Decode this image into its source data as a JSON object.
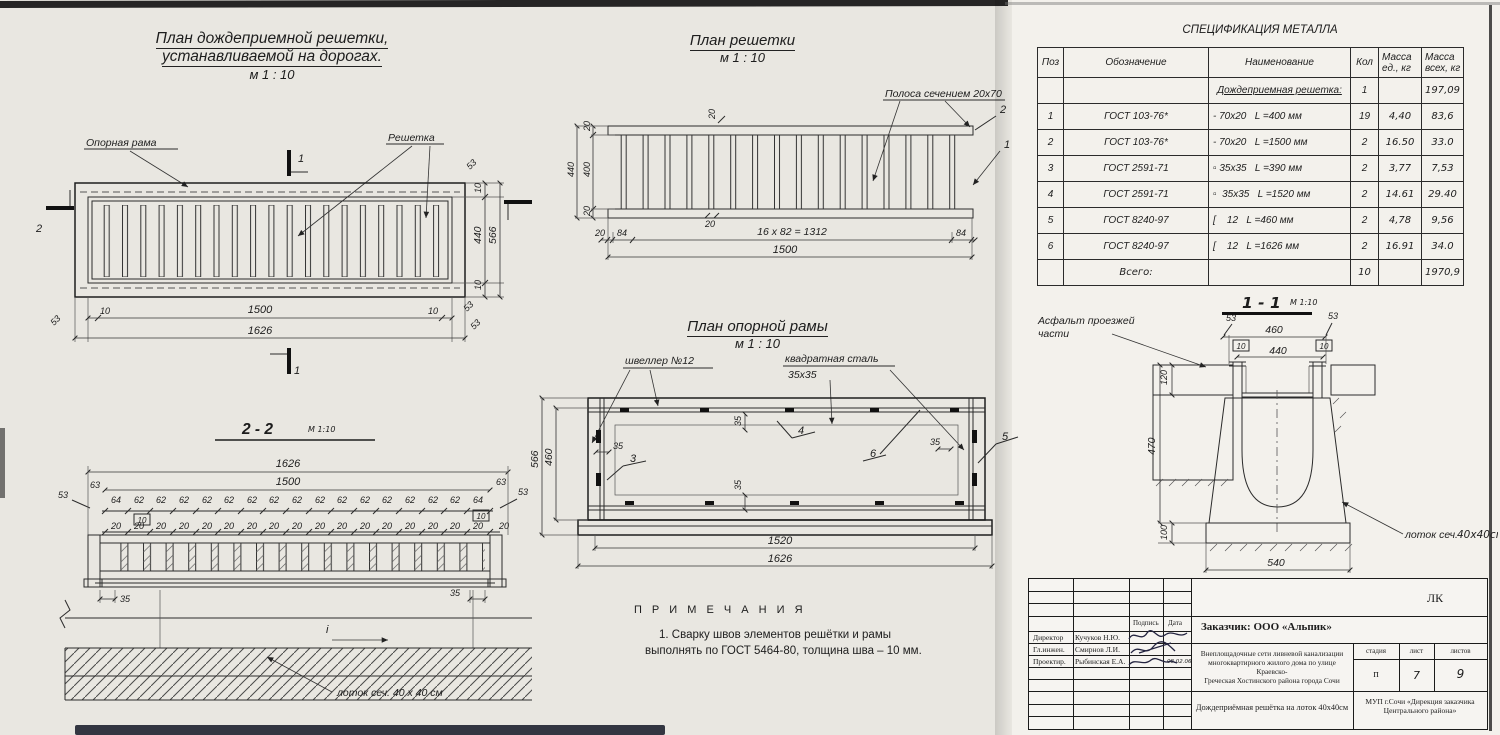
{
  "page": {
    "bg": "#e9e7e1",
    "sheet_bg": "#f3f1ec",
    "ink": "#222222"
  },
  "titles": {
    "plan_road_l1": "План дождеприемной решетки,",
    "plan_road_l2": "устанавливаемой на дорогах.",
    "scale_m110": "м 1 : 10",
    "plan_grate": "План решетки",
    "plan_frame": "План опорной рамы",
    "sec22": "2 - 2",
    "sec22_scale": "М 1:10",
    "sec11": "1 - 1",
    "sec11_scale": "М 1:10",
    "spec": "СПЕЦИФИКАЦИЯ МЕТАЛЛА",
    "notes": "П Р И М Е Ч А Н И Я"
  },
  "labels": {
    "oporna": "Опорная рама",
    "reshetka": "Решетка",
    "polosa": "Полоса сечением 20x70",
    "shveller": "швеллер №12",
    "kvadrat_l1": "квадратная сталь",
    "kvadrat_l2": "35x35",
    "asphalt_l1": "Асфальт проезжей",
    "asphalt_l2": "части",
    "lotok22": "лоток сеч. 40 x 40 см",
    "lotok11_a": "лоток сеч.",
    "lotok11_b": "40x40см",
    "slope_i": "i"
  },
  "notes_list": {
    "n1_l1": "1. Сварку швов элементов решётки и рамы",
    "n1_l2": "выполнять по ГОСТ 5464-80, толщина шва – 10 мм."
  },
  "dims": {
    "d10": "10",
    "d20": "20",
    "d35": "35",
    "d53": "53",
    "d62": "62",
    "d63": "63",
    "d64": "64",
    "d84": "84",
    "d100": "100",
    "d120": "120",
    "d400": "400",
    "d440": "440",
    "d460": "460",
    "d470": "470",
    "d540": "540",
    "d566": "566",
    "d1312": "16 x 82 = 1312",
    "d1500": "1500",
    "d1520": "1520",
    "d1626": "1626"
  },
  "marks": {
    "m1": "1",
    "m2": "2",
    "c1": "1",
    "c2": "2",
    "c3": "3",
    "c4": "4",
    "c5": "5",
    "c6": "6"
  },
  "spec_table": {
    "h_pos": "Поз",
    "h_obozn": "Обозначение",
    "h_name": "Наименование",
    "h_qty": "Кол",
    "h_m1a": "Масса",
    "h_m1b": "ед.,  кг",
    "h_m2a": "Масса",
    "h_m2b": "всех, кг",
    "group": {
      "name": "Дождеприемная решетка:",
      "qty": "1",
      "total": "197,09"
    },
    "rows": [
      {
        "pos": "1",
        "gost": "ГОСТ 103-76*",
        "name": "- 70x20   L =400 мм",
        "qty": "19",
        "unit": "4,40",
        "total": "83,6"
      },
      {
        "pos": "2",
        "gost": "ГОСТ 103-76*",
        "name": "- 70x20   L =1500 мм",
        "qty": "2",
        "unit": "16.50",
        "total": "33.0"
      },
      {
        "pos": "3",
        "gost": "ГОСТ 2591-71",
        "name": "▫ 35x35   L =390 мм",
        "qty": "2",
        "unit": "3,77",
        "total": "7,53"
      },
      {
        "pos": "4",
        "gost": "ГОСТ 2591-71",
        "name": "▫  35x35   L =1520 мм",
        "qty": "2",
        "unit": "14.61",
        "total": "29.40"
      },
      {
        "pos": "5",
        "gost": "ГОСТ 8240-97",
        "name": "[    12   L =460 мм",
        "qty": "2",
        "unit": "4,78",
        "total": "9,56"
      },
      {
        "pos": "6",
        "gost": "ГОСТ 8240-97",
        "name": "[    12   L =1626 мм",
        "qty": "2",
        "unit": "16.91",
        "total": "34.0"
      }
    ],
    "total": {
      "label": "Всего:",
      "qty": "10",
      "total": "1970,9"
    }
  },
  "stamp": {
    "code": "ЛК",
    "sign_h": "Подпись",
    "date_h": "Дата",
    "roles": [
      {
        "role": "Директор",
        "name": "Кучуков Н.Ю."
      },
      {
        "role": "Гл.инжен.",
        "name": "Смирнов Л.И."
      },
      {
        "role": "Проектир.",
        "name": "Рыбинская Е.А."
      }
    ],
    "small_date": "08.02.06",
    "customer": "Заказчик:  ООО «Альпик»",
    "project_l1": "Внеплощадочные сети ливневой канализации",
    "project_l2": "многоквартирного жилого дома по улице Краевско-",
    "project_l3": "Греческая Хостинского района города Сочи",
    "stage_h": "стадия",
    "sheet_h": "лист",
    "sheets_h": "листов",
    "stage": "п",
    "sheet": "7",
    "sheets": "9",
    "doc_title": "Дождеприёмная решётка на лоток 40x40см",
    "org_l1": "МУП г.Сочи «Дирекция заказчика",
    "org_l2": "Центрального района»"
  }
}
